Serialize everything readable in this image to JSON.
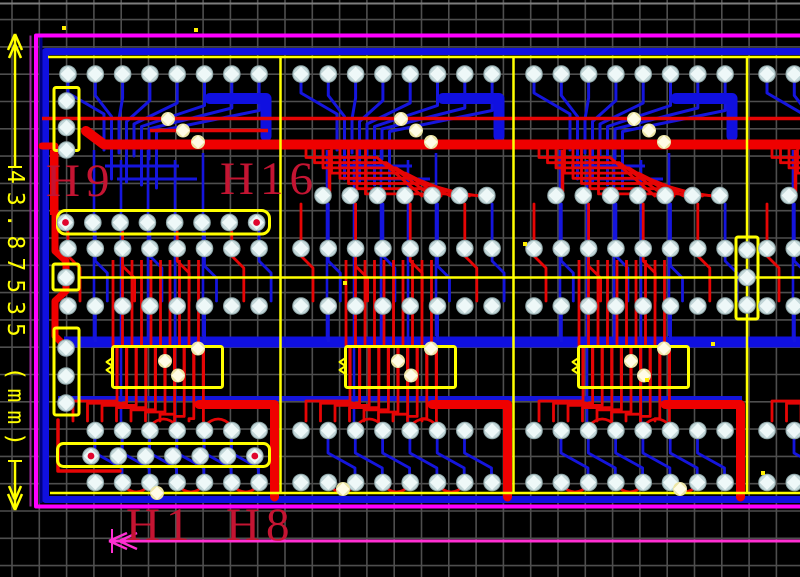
{
  "window": {
    "title": "PCB layout viewport",
    "width": 800,
    "height": 577,
    "background": "#000000"
  },
  "grid": {
    "spacing": 27.3,
    "offset_x": 12,
    "offset_y": 19.6,
    "color": "#4e4e4e",
    "line_width": 1.6,
    "top_edge_line_y": 3.5,
    "top_edge_line_color": "#7d7d7d"
  },
  "palette": {
    "red": "#e60505",
    "red_thick": "#ef0000",
    "blue": "#1515dd",
    "blue_thick": "#1010e0",
    "navy": "#000082",
    "yellow": "#ffff00",
    "magenta": "#ff00ff",
    "dim_pink": "#ff2fd2",
    "purple_thin": "#9c2a9c",
    "label_red": "#c41432",
    "pad_ring": "#c3d7d9",
    "pad_core": "#eef8f8",
    "via_ring": "#ece5a6",
    "via_core": "#fffce6",
    "hole_red": "#e0052d",
    "dot_yellow": "#ffee00"
  },
  "labels": {
    "h9": {
      "text": "H9",
      "x": 46,
      "y": 158
    },
    "h16": {
      "text": "H16",
      "x": 220,
      "y": 156
    },
    "h1": {
      "text": "H1",
      "x": 126,
      "y": 502
    },
    "h8": {
      "text": "H8",
      "x": 226,
      "y": 502
    }
  },
  "dimension_left": {
    "text": "43.87535 (mm)",
    "axis_x": 15,
    "arrow_top_y": 34,
    "arrow_bottom_y": 510,
    "text_top_y": 170,
    "text_bottom_y": 458
  },
  "dimension_bottom": {
    "y": 541,
    "arrow_tip_x": 109,
    "right_x": 800
  },
  "render": {
    "board": {
      "outline_left_x": 36,
      "outline_top_y": 35.5,
      "outline_bottom_y": 506.5,
      "purple_guide_x": 30.5,
      "navy_x": 41,
      "blue_ring_x": 45.5,
      "blue_ring_top_y": 51.5,
      "blue_ring_bottom_y": 499.5,
      "yellow_top_y": 57,
      "yellow_bottom_y": 493,
      "yellow_mid_y": 277.5
    },
    "buses": {
      "red_thin_y": 118.5,
      "red_thick_y": 144.5,
      "blue_thick_y": 342,
      "blue_low_y": 398.5
    },
    "section_xs": [
      47,
      280,
      513,
      746
    ],
    "boundary_xs": [
      280.5,
      513.5,
      747
    ],
    "pad_pitch": 27.3,
    "rows": {
      "top": 74,
      "upper": 195.5,
      "mid1": 248.5,
      "mid2": 306,
      "lower": 430.5,
      "bottom": 482.5
    },
    "ic": {
      "dx": 65.5,
      "y": 346.5,
      "w": 110,
      "h": 41
    },
    "connectors": [
      {
        "name": "connector-h9-h16",
        "rect": [
          57.5,
          210.5,
          212,
          23.5
        ],
        "rx": 8,
        "pads": [
          [
            65.5,
            222.5,
            1
          ],
          [
            92.8,
            222.5,
            0
          ],
          [
            120.1,
            222.5,
            0
          ],
          [
            147.4,
            222.5,
            0
          ],
          [
            174.7,
            222.5,
            0
          ],
          [
            202,
            222.5,
            0
          ],
          [
            229.3,
            222.5,
            0
          ],
          [
            256.6,
            222.5,
            1
          ]
        ]
      },
      {
        "name": "connector-h1-h8",
        "rect": [
          57.5,
          443.5,
          212,
          23
        ],
        "rx": 6,
        "pads": [
          [
            91,
            456,
            1
          ],
          [
            118.3,
            456,
            0
          ],
          [
            145.6,
            456,
            0
          ],
          [
            172.9,
            456,
            0
          ],
          [
            200.2,
            456,
            0
          ],
          [
            227.5,
            456,
            0
          ],
          [
            254.8,
            456,
            1
          ]
        ]
      },
      {
        "name": "connector-left-top",
        "rect": [
          54,
          87.5,
          25,
          63
        ],
        "rx": 2,
        "pads": [
          [
            66.5,
            101,
            0
          ],
          [
            66.5,
            127.5,
            0
          ],
          [
            66.5,
            150,
            0
          ]
        ]
      },
      {
        "name": "connector-left-mid",
        "rect": [
          54,
          328,
          25,
          87
        ],
        "rx": 2,
        "pads": [
          [
            66,
            348,
            0
          ],
          [
            66,
            376,
            0
          ],
          [
            66,
            403,
            0
          ]
        ]
      },
      {
        "name": "square-pad-outline",
        "rect": [
          53,
          264,
          26,
          26
        ],
        "rx": 2,
        "pads": [
          [
            66,
            277.5,
            0
          ]
        ]
      },
      {
        "name": "connector-right",
        "rect": [
          736,
          237,
          22,
          82
        ],
        "rx": 2,
        "pads": [
          [
            747,
            250,
            0
          ],
          [
            747,
            277.5,
            0
          ],
          [
            747,
            305,
            0
          ]
        ]
      }
    ],
    "vias": [
      [
        343,
        489
      ],
      [
        680,
        489
      ],
      [
        157,
        493
      ]
    ],
    "yellow_dots": [
      [
        64,
        28
      ],
      [
        196,
        30
      ],
      [
        345,
        283
      ],
      [
        525,
        244
      ],
      [
        647,
        380
      ],
      [
        713,
        344
      ],
      [
        763,
        473
      ]
    ]
  }
}
